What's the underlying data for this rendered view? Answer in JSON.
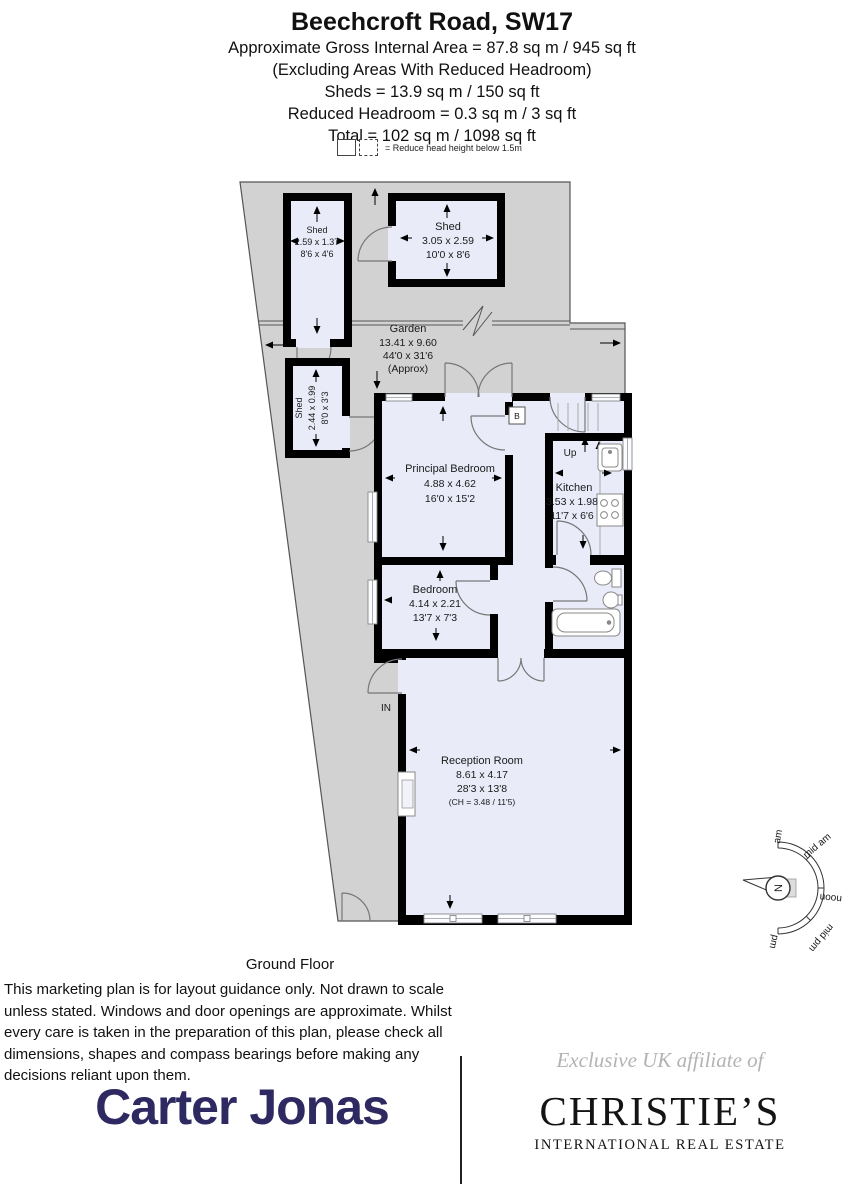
{
  "header": {
    "title": "Beechcroft Road, SW17",
    "area_lines": [
      "Approximate Gross Internal Area = 87.8 sq m / 945 sq ft",
      "(Excluding Areas With Reduced Headroom)",
      "Sheds = 13.9 sq m / 150 sq ft",
      "Reduced Headroom = 0.3 sq m / 3 sq ft",
      "Total = 102 sq m / 1098 sq ft"
    ],
    "legend": "= Reduce head height below 1.5m"
  },
  "plan": {
    "garden": {
      "name": "Garden",
      "metric": "13.41 x 9.60",
      "imperial": "44'0 x 31'6",
      "note": "(Approx)"
    },
    "shed_small": {
      "name": "Shed",
      "metric": "2.59 x 1.37",
      "imperial": "8'6 x 4'6"
    },
    "shed_large": {
      "name": "Shed",
      "metric": "3.05 x 2.59",
      "imperial": "10'0 x 8'6"
    },
    "shed_side": {
      "name": "Shed",
      "metric": "2.44 x 0.99",
      "imperial": "8'0 x 3'3"
    },
    "principal_bedroom": {
      "name": "Principal Bedroom",
      "metric": "4.88 x 4.62",
      "imperial": "16'0 x 15'2"
    },
    "kitchen": {
      "name": "Kitchen",
      "metric": "3.53 x 1.98",
      "imperial": "11'7 x 6'6"
    },
    "bedroom": {
      "name": "Bedroom",
      "metric": "4.14 x 2.21",
      "imperial": "13'7 x 7'3"
    },
    "reception": {
      "name": "Reception Room",
      "metric": "8.61 x 4.17",
      "imperial": "28'3 x 13'8",
      "ceiling": "(CH = 3.48 / 11'5)"
    },
    "labels": {
      "up": "Up",
      "entrance": "IN",
      "boiler": "B"
    }
  },
  "compass": {
    "north": "N",
    "labels": [
      "am",
      "mid am",
      "noon",
      "mid pm",
      "pm"
    ]
  },
  "footer": {
    "floor_label": "Ground Floor",
    "disclaimer": "This marketing plan is for layout guidance only. Not drawn to scale unless stated. Windows and door openings are approximate. Whilst every care is taken in the preparation of this plan, please check all dimensions, shapes and compass bearings before making any decisions reliant upon them."
  },
  "branding": {
    "agent": "Carter Jonas",
    "affiliate_line": "Exclusive UK affiliate of",
    "affiliate_name": "CHRISTIE’S",
    "affiliate_sub": "INTERNATIONAL REAL ESTATE"
  },
  "colors": {
    "floor": "#e9ecf8",
    "garden": "#d2d2d2",
    "wall": "#000000",
    "agent_navy": "#2e2a61"
  }
}
